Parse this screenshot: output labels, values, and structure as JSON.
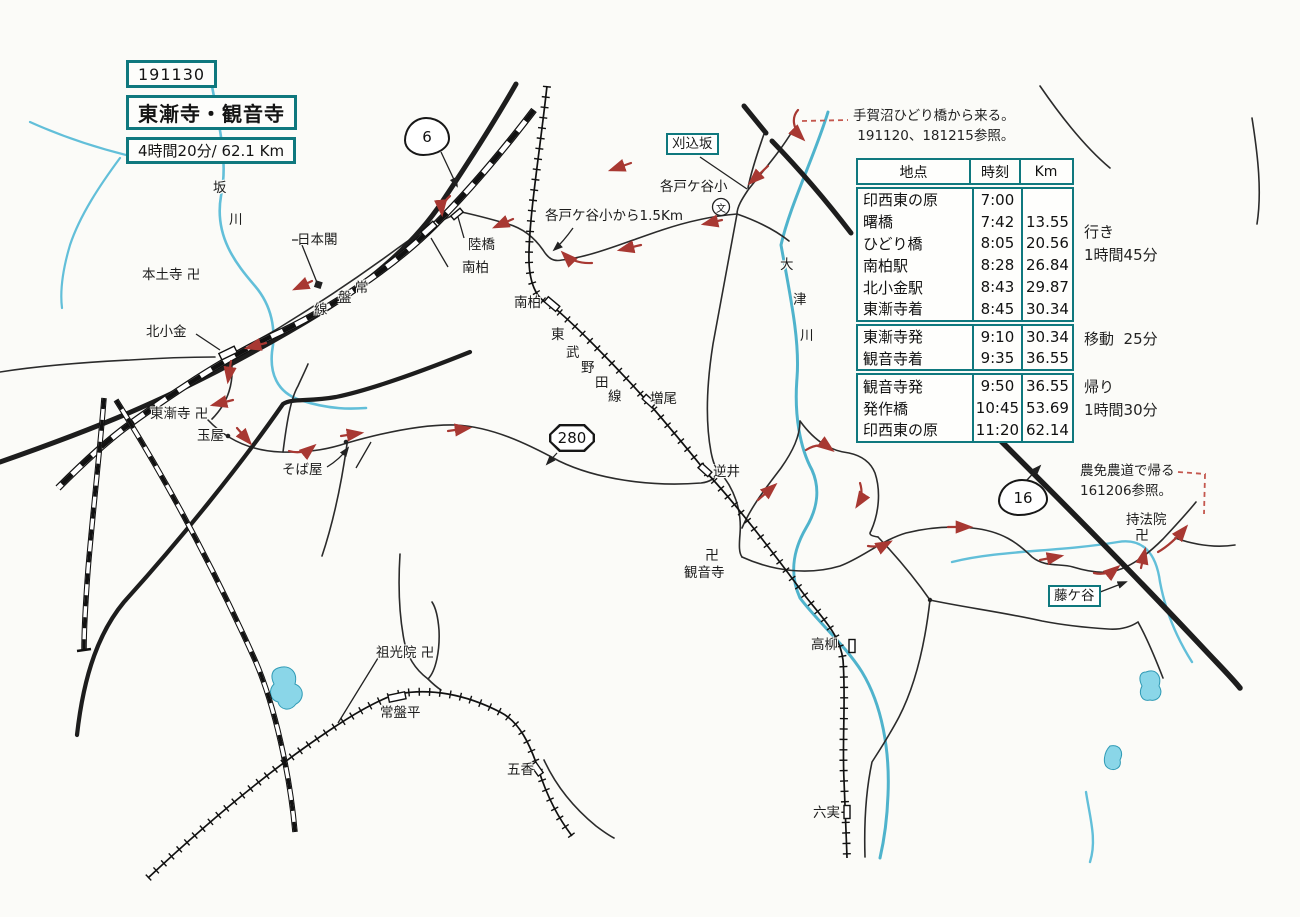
{
  "header": {
    "date": "191130",
    "title": "東漸寺・観音寺",
    "duration": "4時間20分/ 62.1 Km"
  },
  "timetable": {
    "headers": [
      "地点",
      "時刻",
      "Km"
    ],
    "sections": [
      {
        "rows": [
          [
            "印西東の原",
            "7:00",
            ""
          ],
          [
            "曙橋",
            "7:42",
            "13.55"
          ],
          [
            "ひどり橋",
            "8:05",
            "20.56"
          ],
          [
            "南柏駅",
            "8:28",
            "26.84"
          ],
          [
            "北小金駅",
            "8:43",
            "29.87"
          ],
          [
            "東漸寺着",
            "8:45",
            "30.34"
          ]
        ]
      },
      {
        "rows": [
          [
            "東漸寺発",
            "9:10",
            "30.34"
          ],
          [
            "観音寺着",
            "9:35",
            "36.55"
          ]
        ]
      },
      {
        "rows": [
          [
            "観音寺発",
            "9:50",
            "36.55"
          ],
          [
            "発作橋",
            "10:45",
            "53.69"
          ],
          [
            "印西東の原",
            "11:20",
            "62.14"
          ]
        ]
      }
    ]
  },
  "colors": {
    "accent_teal": "#0f787e",
    "route_red": "#a83832",
    "river_blue": "#62bfd9"
  },
  "map": {
    "annotations": [
      {
        "id": "note-start",
        "cls": "note",
        "x": 853,
        "y": 106,
        "lines": [
          "手賀沼ひどり橋から来る。",
          " 191120、181215参照。"
        ]
      },
      {
        "id": "note-return",
        "cls": "note",
        "x": 1080,
        "y": 461,
        "lines": [
          "農免農道で帰る",
          "161206参照。"
        ]
      },
      {
        "id": "leg-going",
        "cls": "leg",
        "x": 1084,
        "y": 221,
        "lines": [
          "行き",
          "1時間45分"
        ]
      },
      {
        "id": "leg-transfer",
        "cls": "leg",
        "x": 1084,
        "y": 328,
        "lines": [
          "移動  25分"
        ]
      },
      {
        "id": "leg-return",
        "cls": "leg",
        "x": 1084,
        "y": 376,
        "lines": [
          "帰り",
          "1時間30分"
        ]
      }
    ],
    "labels": [
      {
        "id": "label-sakagawa-1",
        "t": "坂",
        "x": 213,
        "y": 181
      },
      {
        "id": "label-sakagawa-2",
        "t": "川",
        "x": 229,
        "y": 213
      },
      {
        "id": "label-hondoji",
        "t": "本土寺 卍",
        "x": 142,
        "y": 268
      },
      {
        "id": "label-nihonkaku",
        "t": "日本閣",
        "x": 297,
        "y": 233
      },
      {
        "id": "label-kitakogane",
        "t": "北小金",
        "x": 146,
        "y": 325
      },
      {
        "id": "label-tosenji",
        "t": "東漸寺 卍",
        "x": 150,
        "y": 407
      },
      {
        "id": "label-tamaya",
        "t": "玉屋",
        "x": 197,
        "y": 429
      },
      {
        "id": "label-sobaya",
        "t": "そば屋",
        "x": 282,
        "y": 463
      },
      {
        "id": "label-jobansen-1",
        "t": "常",
        "x": 355,
        "y": 281
      },
      {
        "id": "label-jobansen-2",
        "t": "盤",
        "x": 338,
        "y": 291
      },
      {
        "id": "label-jobansen-3",
        "t": "線",
        "x": 314,
        "y": 303
      },
      {
        "id": "label-rikkyo",
        "t": "陸橋",
        "x": 468,
        "y": 238
      },
      {
        "id": "label-minamikashiwa-jr",
        "t": "南柏",
        "x": 462,
        "y": 261
      },
      {
        "id": "label-kakudogaya-dist",
        "t": "各戸ケ谷小から1.5Km",
        "x": 545,
        "y": 209
      },
      {
        "id": "label-minamikashiwa-tobu",
        "t": "南柏",
        "x": 514,
        "y": 296
      },
      {
        "id": "label-tobunodasen-1",
        "t": "東",
        "x": 551,
        "y": 328
      },
      {
        "id": "label-tobunodasen-2",
        "t": "武",
        "x": 566,
        "y": 346
      },
      {
        "id": "label-tobunodasen-3",
        "t": "野",
        "x": 581,
        "y": 361
      },
      {
        "id": "label-tobunodasen-4",
        "t": "田",
        "x": 595,
        "y": 376
      },
      {
        "id": "label-tobunodasen-5",
        "t": "線",
        "x": 608,
        "y": 390
      },
      {
        "id": "label-masuo",
        "t": "増尾",
        "x": 650,
        "y": 392
      },
      {
        "id": "label-kakudogaya-school",
        "t": "各戸ケ谷小",
        "x": 660,
        "y": 180
      },
      {
        "id": "label-school-symbol",
        "t": "文",
        "cls": "school",
        "x": 716,
        "y": 202
      },
      {
        "id": "label-karikomizaka",
        "t": "刈込坂",
        "cls": "boxed",
        "x": 666,
        "y": 133
      },
      {
        "id": "label-otsugawa-1",
        "t": "大",
        "x": 780,
        "y": 258
      },
      {
        "id": "label-otsugawa-2",
        "t": "津",
        "x": 793,
        "y": 293
      },
      {
        "id": "label-otsugawa-3",
        "t": "川",
        "x": 800,
        "y": 329
      },
      {
        "id": "label-sakasai",
        "t": "逆井",
        "x": 713,
        "y": 465
      },
      {
        "id": "label-kannonji-manji",
        "t": "卍",
        "cls": "manji",
        "x": 705,
        "y": 549
      },
      {
        "id": "label-kannonji",
        "t": "観音寺",
        "x": 684,
        "y": 566
      },
      {
        "id": "label-sokoin",
        "t": "祖光院 卍",
        "x": 376,
        "y": 646
      },
      {
        "id": "label-tokiwadaira",
        "t": "常盤平",
        "x": 380,
        "y": 706
      },
      {
        "id": "label-goko",
        "t": "五香",
        "x": 507,
        "y": 763
      },
      {
        "id": "label-takayanagi",
        "t": "高柳",
        "x": 811,
        "y": 638
      },
      {
        "id": "label-mutsumi",
        "t": "六実",
        "x": 813,
        "y": 806
      },
      {
        "id": "label-fujigaya",
        "t": "藤ケ谷",
        "cls": "boxed",
        "x": 1048,
        "y": 585
      },
      {
        "id": "label-jihoin",
        "t": "持法院",
        "x": 1126,
        "y": 513
      },
      {
        "id": "label-jihoin-manji",
        "t": "卍",
        "cls": "manji",
        "x": 1135,
        "y": 529
      }
    ],
    "shields": [
      {
        "id": "route-6",
        "n": "6",
        "shape": "blob",
        "x": 404,
        "y": 117,
        "w": 42,
        "h": 35
      },
      {
        "id": "route-280",
        "n": "280",
        "shape": "oct",
        "x": 549,
        "y": 424,
        "w": 46,
        "h": 28
      },
      {
        "id": "route-16",
        "n": "16",
        "shape": "blob",
        "x": 998,
        "y": 479,
        "w": 46,
        "h": 33
      }
    ]
  }
}
